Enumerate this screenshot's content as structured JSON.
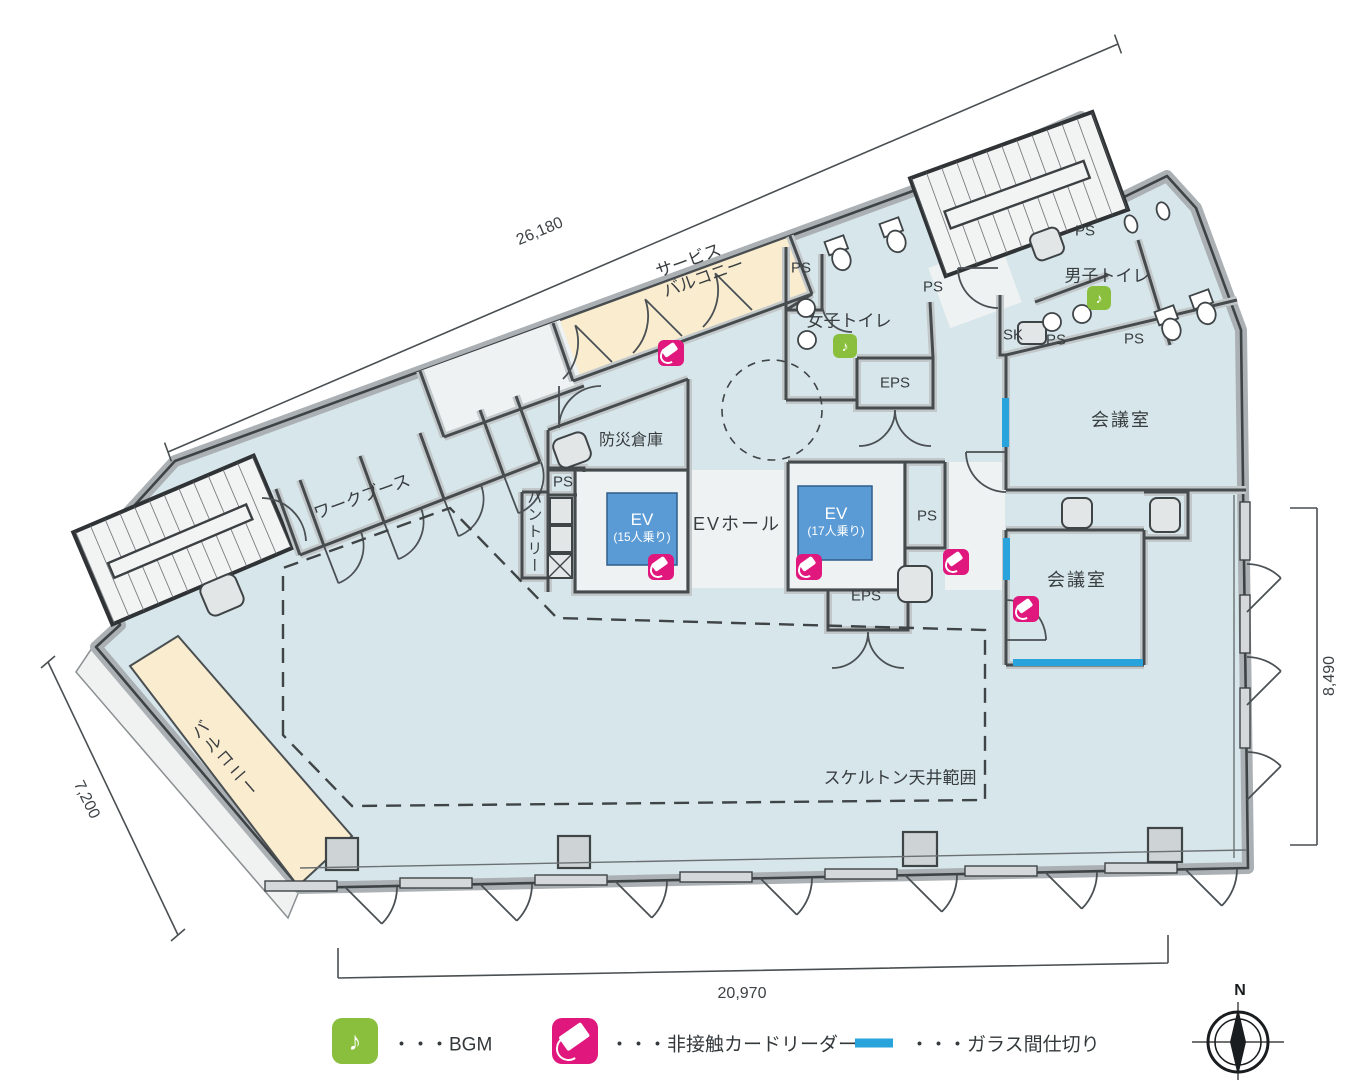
{
  "plan": {
    "dimensions": {
      "top": "26,180",
      "left": "7,200",
      "right": "8,490",
      "bottom": "20,970"
    },
    "rooms": {
      "service_balcony_line1": "サービス",
      "service_balcony_line2": "バルコニー",
      "womens_toilet": "女子トイレ",
      "mens_toilet": "男子トイレ",
      "meeting_room_a": "会議室",
      "meeting_room_b": "会議室",
      "disaster_storage": "防災倉庫",
      "work_booth": "ワークブース",
      "pantry": "パントリー",
      "ev_hall": "EVホール",
      "ev1_name": "EV",
      "ev1_capacity": "(15人乗り)",
      "ev2_name": "EV",
      "ev2_capacity": "(17人乗り)",
      "balcony": "バルコニー",
      "skeleton_ceiling": "スケルトン天井範囲",
      "eps": "EPS",
      "sk": "SK",
      "ps": "PS"
    },
    "legend": {
      "bgm_glyph": "♪",
      "bgm_label": "・・・BGM",
      "card_reader_label": "・・・非接触カードリーダー",
      "glass_partition_label": "・・・ガラス間仕切り"
    },
    "compass": {
      "north": "N"
    },
    "colors": {
      "floor": "#d7e6ea",
      "balcony": "#faeccf",
      "elevator": "#5b9bd5",
      "card_reader": "#e0187d",
      "bgm_green": "#8abf3e",
      "glass_partition": "#29a3dc",
      "wall": "#aab0b3"
    }
  }
}
